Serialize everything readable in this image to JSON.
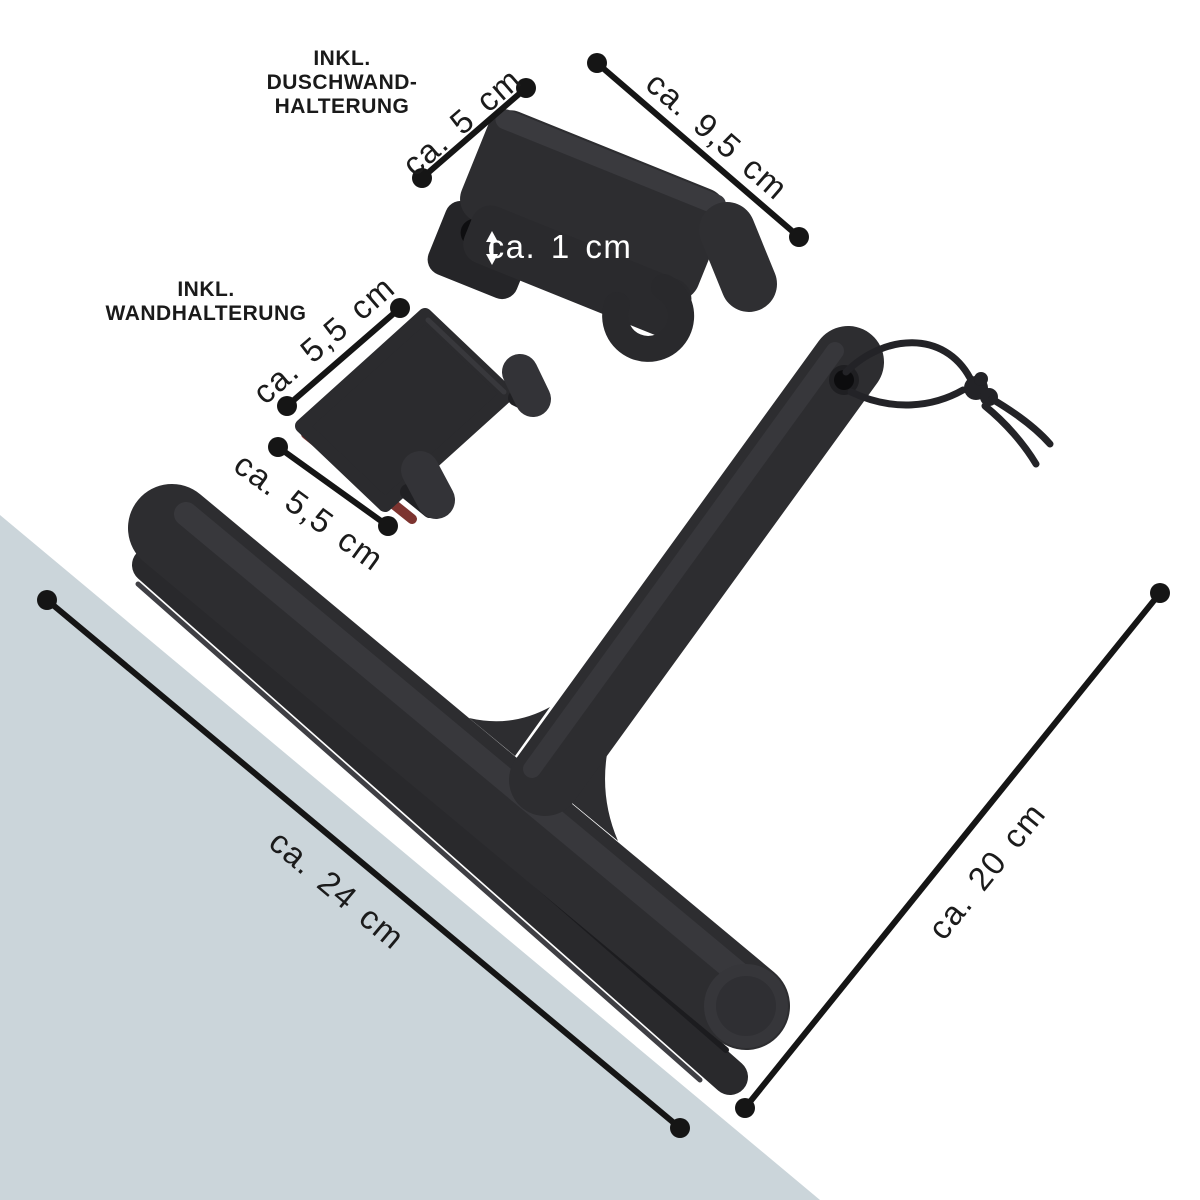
{
  "image": {
    "description": "Product photo of a black silicone shower squeegee with included shower-door holder and adhesive wall holder, annotated with size dimensions",
    "background_color": "#ffffff",
    "accent_triangle_color": "#cbd5da",
    "product_color": "#2d2d30",
    "annotation_color": "#151515",
    "adhesive_strip_color": "#7d3430"
  },
  "labels": {
    "shower_door_holder": {
      "line1": "INKL.",
      "line2": "DUSCHWAND-",
      "line3": "HALTERUNG"
    },
    "wall_holder": {
      "line1": "INKL.",
      "line2": "WANDHALTERUNG"
    }
  },
  "dimensions": {
    "door_holder_width": "ca. 5 cm",
    "door_holder_length": "ca. 9,5 cm",
    "door_holder_gap": "ca. 1 cm",
    "wall_holder_width": "ca. 5,5 cm",
    "wall_holder_depth": "ca. 5,5 cm",
    "squeegee_blade_width": "ca. 24 cm",
    "squeegee_length": "ca. 20 cm"
  }
}
